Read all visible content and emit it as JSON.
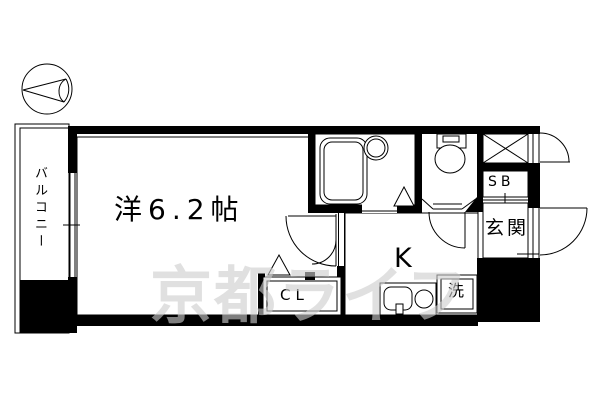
{
  "plan": {
    "type": "japanese-apartment-floor-plan",
    "labels": {
      "balcony": "バルコニー",
      "room": "洋6.2帖",
      "kitchen": "K",
      "closet": "CL",
      "shoe_box": "SB",
      "entrance": "玄関",
      "washer": "洗"
    },
    "watermark": "京都ライフ",
    "icons": {
      "compass": "north-arrow-circle-pointing-left",
      "cross_box": "shaft-or-storage-x-symbol",
      "triangles": "folding-door-markers"
    },
    "colors": {
      "line": "#000000",
      "background": "#ffffff",
      "watermark": "#cdcdcd"
    }
  }
}
